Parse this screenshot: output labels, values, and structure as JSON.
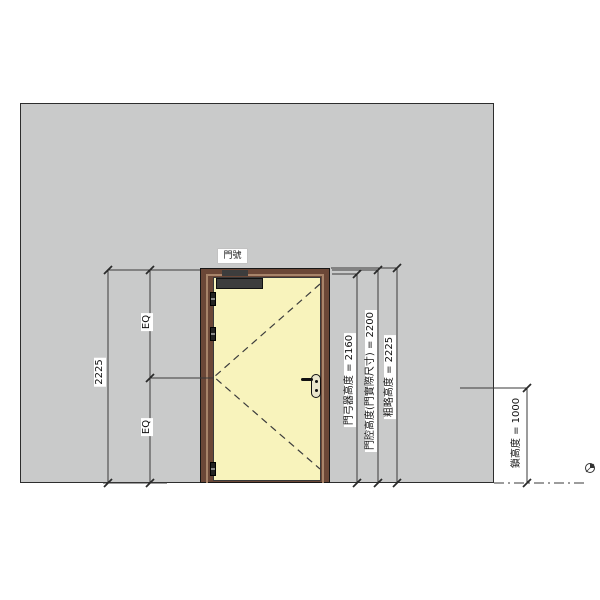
{
  "drawing": {
    "door_tag": "門號",
    "dimensions": {
      "overall_height": "2225",
      "eq_upper": "EQ",
      "eq_lower": "EQ",
      "door_closer_height": "門弓器高度 = 2160",
      "door_leaf_height": "門腔高度(門實際尺寸) = 2200",
      "rough_height": "粗略高度 = 2225",
      "lock_height": "鎖高度 = 1000"
    },
    "colors": {
      "wall_fill": "#c9caca",
      "door_leaf_fill": "#f8f3bc",
      "door_frame_fill": "#6b4737",
      "door_frame_inner": "#a8846a",
      "dimension_line": "#3a3a3a"
    }
  }
}
